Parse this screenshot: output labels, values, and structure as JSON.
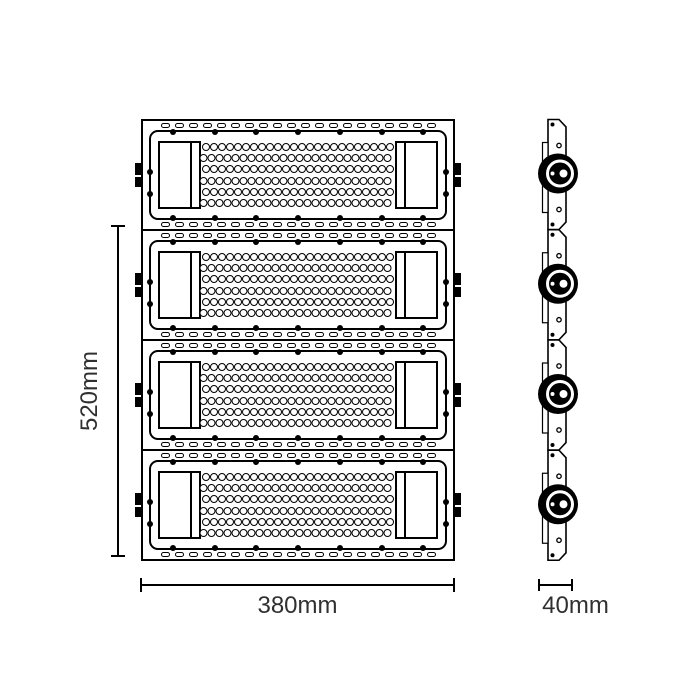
{
  "drawing": {
    "description": "Technical dimension drawing of a 4-module LED flood light, front view and side profile view",
    "front_view": {
      "module_count": 4,
      "module": {
        "slot_count_top": 20,
        "slot_count_bottom": 20,
        "screw_count_top": 7,
        "screw_count_bottom": 7,
        "screw_count_left": 2,
        "screw_count_right": 2,
        "led_rows": 6,
        "led_cols": 24,
        "side_tabs_per_side": 2
      }
    },
    "side_view": {
      "module_count": 4,
      "knob_per_module": 1
    },
    "dimensions": {
      "height_label": "520mm",
      "width_label": "380mm",
      "depth_label": "40mm"
    },
    "colors": {
      "line": "#000000",
      "text": "#303030",
      "background": "#ffffff"
    }
  }
}
